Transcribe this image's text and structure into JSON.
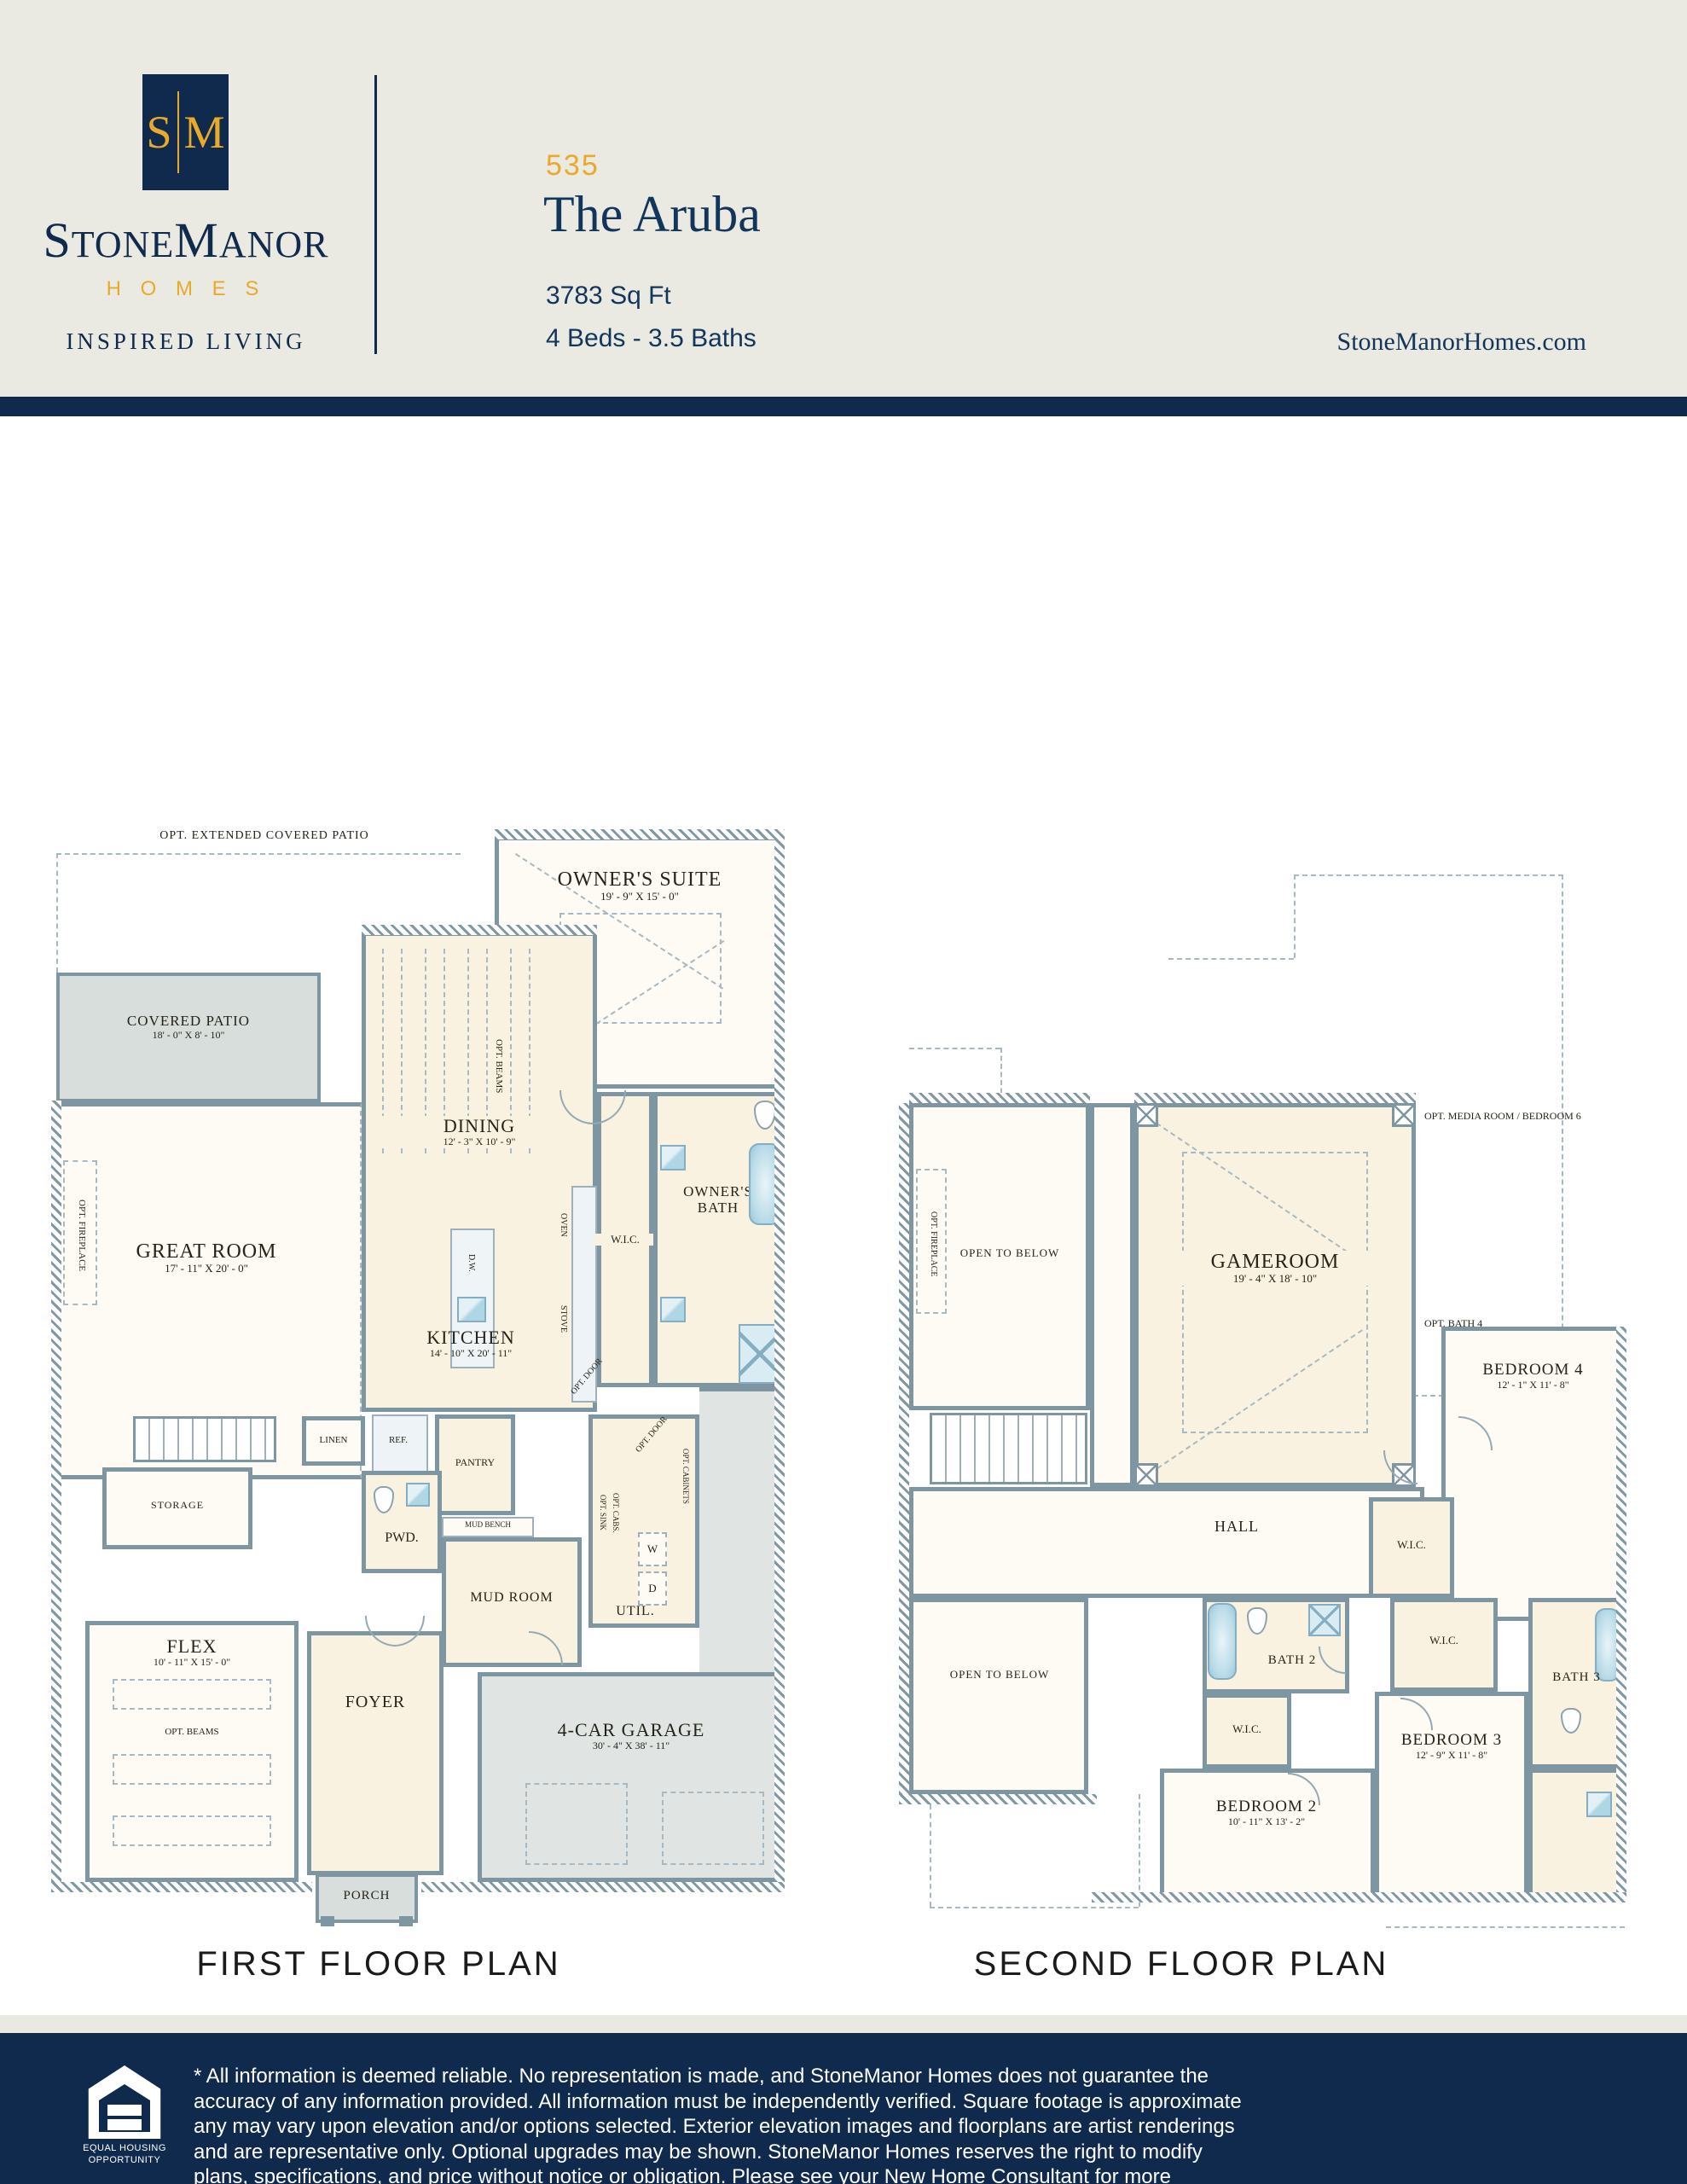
{
  "header": {
    "logo": {
      "initial_s": "S",
      "initial_m": "M",
      "brand_part1": "S",
      "brand_part2": "TONE",
      "brand_part3": "M",
      "brand_part4": "ANOR",
      "brand_sub": "H O M E S",
      "tagline": "INSPIRED LIVING"
    },
    "plan_number": "535",
    "plan_name": "The Aruba",
    "sq_ft": "3783 Sq Ft",
    "beds_baths": "4 Beds - 3.5 Baths",
    "website": "StoneManorHomes.com",
    "colors": {
      "navy": "#0F2A4D",
      "gold": "#EBA92B",
      "header_bg": "#EAE9E2"
    }
  },
  "first_floor": {
    "caption": "FIRST FLOOR PLAN",
    "opt_extended_patio": "OPT. EXTENDED COVERED PATIO",
    "covered_patio": {
      "name": "COVERED PATIO",
      "dims": "18' - 0\" X 8' - 10\""
    },
    "owners_suite": {
      "name": "OWNER'S SUITE",
      "dims": "19' - 9\" X 15' - 0\""
    },
    "dining": {
      "name": "DINING",
      "dims": "12' - 3\" X 10' - 9\""
    },
    "great_room": {
      "name": "GREAT ROOM",
      "dims": "17' - 11\" X 20' - 0\""
    },
    "kitchen": {
      "name": "KITCHEN",
      "dims": "14' - 10\" X 20' - 11\""
    },
    "flex": {
      "name": "FLEX",
      "dims": "10' - 11\" X 15' - 0\""
    },
    "garage": {
      "name": "4-CAR GARAGE",
      "dims": "30' - 4\" X 38' - 11\""
    },
    "wic": "W.I.C.",
    "owners_bath": "OWNER'S BATH",
    "opt_fireplace": "OPT. FIREPLACE",
    "opt_beams": "OPT. BEAMS",
    "oven": "OVEN",
    "stove": "STOVE",
    "dw": "D.W.",
    "ref": "REF.",
    "linen": "LINEN",
    "pantry": "PANTRY",
    "pwd": "PWD.",
    "mud_bench": "MUD BENCH",
    "mud_room": "MUD ROOM",
    "util": "UTIL.",
    "washer": "W",
    "dryer": "D",
    "opt_sink": "OPT. SINK",
    "opt_cabs": "OPT. CABS.",
    "opt_door": "OPT. DOOR",
    "opt_cabinets": "OPT. CABINETS",
    "storage": "STORAGE",
    "foyer": "FOYER",
    "porch": "PORCH"
  },
  "second_floor": {
    "caption": "SECOND FLOOR PLAN",
    "open_to_below": "OPEN TO BELOW",
    "opt_fireplace": "OPT. FIREPLACE",
    "gameroom": {
      "name": "GAMEROOM",
      "dims": "19' - 4\" X 18' - 10\""
    },
    "opt_media": "OPT. MEDIA ROOM / BEDROOM 6",
    "opt_bath4": "OPT. BATH 4",
    "hall": "HALL",
    "bedroom4": {
      "name": "BEDROOM 4",
      "dims": "12' - 1\" X 11' - 8\""
    },
    "bedroom2": {
      "name": "BEDROOM 2",
      "dims": "10' - 11\" X 13' - 2\""
    },
    "bedroom3": {
      "name": "BEDROOM 3",
      "dims": "12' - 9\" X 11' - 8\""
    },
    "bath2": "BATH 2",
    "bath3": "BATH 3",
    "wic": "W.I.C."
  },
  "footer": {
    "eho": {
      "line1": "EQUAL HOUSING",
      "line2": "OPPORTUNITY"
    },
    "disclaimer": "* All information is deemed reliable. No representation is made, and StoneManor Homes does not guarantee the accuracy of any information provided. All information must be independently verified. Square footage is approximate any may vary upon elevation and/or options selected. Exterior elevation images and floorplans are artist renderings and are representative only. Optional upgrades may be shown. StoneManor Homes reserves the right to modify plans, specifications, and price without notice or obligation. Please see your New Home Consultant for more information. 2025-07-19"
  }
}
